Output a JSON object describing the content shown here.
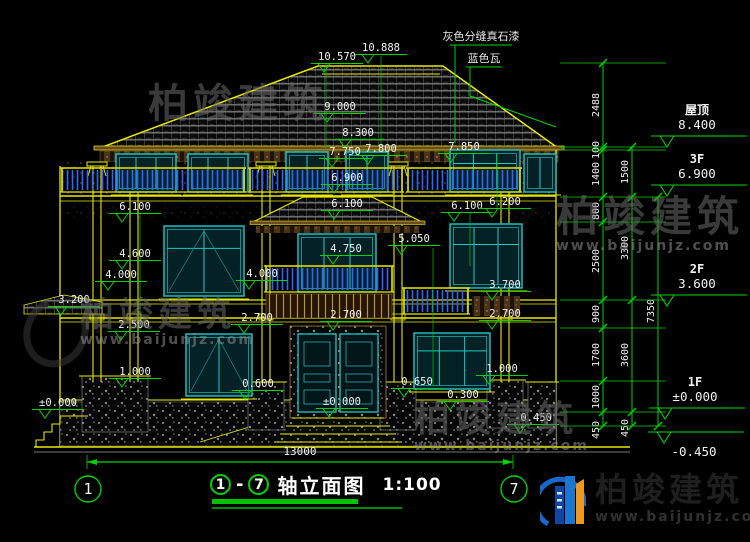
{
  "meta": {
    "bg": "#000000",
    "cad_yellow": "#e8e800",
    "dim_green": "#00d400",
    "window_cyan": "#20c8c8",
    "rail_blue": "#2e68ff",
    "text_white": "#f2f2f2"
  },
  "annotations": {
    "roof_notes": [
      {
        "text": "灰色分缝真石漆",
        "x": 481,
        "y": 40,
        "ul": [
          450,
          512,
          45
        ],
        "leader": [
          [
            455,
            45
          ],
          [
            455,
            143
          ]
        ]
      },
      {
        "text": "蓝色瓦",
        "x": 484,
        "y": 62,
        "ul": [
          466,
          502,
          67
        ],
        "leader": [
          [
            470,
            67
          ],
          [
            470,
            96
          ],
          [
            556,
            127
          ]
        ]
      }
    ],
    "levels": [
      {
        "v": "10.570",
        "x": 337,
        "y": 60
      },
      {
        "v": "10.888",
        "x": 381,
        "y": 51
      },
      {
        "v": "9.000",
        "x": 340,
        "y": 110
      },
      {
        "v": "8.300",
        "x": 358,
        "y": 136
      },
      {
        "v": "7.750",
        "x": 345,
        "y": 155
      },
      {
        "v": "7.800",
        "x": 381,
        "y": 152
      },
      {
        "v": "7.850",
        "x": 464,
        "y": 150
      },
      {
        "v": "6.900",
        "x": 347,
        "y": 181
      },
      {
        "v": "6.100",
        "x": 135,
        "y": 210
      },
      {
        "v": "6.100",
        "x": 347,
        "y": 207
      },
      {
        "v": "6.100",
        "x": 467,
        "y": 209
      },
      {
        "v": "6.200",
        "x": 505,
        "y": 205
      },
      {
        "v": "4.600",
        "x": 135,
        "y": 257
      },
      {
        "v": "4.750",
        "x": 346,
        "y": 252
      },
      {
        "v": "5.050",
        "x": 414,
        "y": 242
      },
      {
        "v": "4.000",
        "x": 121,
        "y": 278
      },
      {
        "v": "4.000",
        "x": 262,
        "y": 277
      },
      {
        "v": "3.700",
        "x": 505,
        "y": 288
      },
      {
        "v": "3.200",
        "x": 74,
        "y": 303
      },
      {
        "v": "2.500",
        "x": 134,
        "y": 328
      },
      {
        "v": "2.700",
        "x": 257,
        "y": 321
      },
      {
        "v": "2.700",
        "x": 346,
        "y": 318
      },
      {
        "v": "2.700",
        "x": 505,
        "y": 317
      },
      {
        "v": "1.000",
        "x": 135,
        "y": 375
      },
      {
        "v": "1.000",
        "x": 502,
        "y": 372
      },
      {
        "v": "0.600",
        "x": 258,
        "y": 387
      },
      {
        "v": "0.650",
        "x": 417,
        "y": 385
      },
      {
        "v": "0.300",
        "x": 463,
        "y": 398
      },
      {
        "v": "±0.000",
        "x": 58,
        "y": 406
      },
      {
        "v": "±0.000",
        "x": 342,
        "y": 405
      },
      {
        "v": "-0.450",
        "x": 533,
        "y": 421
      }
    ],
    "floor_marks": [
      {
        "label": "屋顶",
        "value": "8.400",
        "x": 697,
        "y": 114
      },
      {
        "label": "3F",
        "value": "6.900",
        "x": 697,
        "y": 163
      },
      {
        "label": "2F",
        "value": "3.600",
        "x": 697,
        "y": 273
      },
      {
        "label": "1F",
        "value": "±0.000",
        "x": 695,
        "y": 386
      },
      {
        "label": "",
        "value": "-0.450",
        "x": 694,
        "y": 456
      }
    ],
    "chains": [
      {
        "x": 603,
        "ticks": [
          63,
          147,
          150,
          197,
          222,
          300,
          328,
          381,
          412,
          426
        ],
        "labels": [
          {
            "t": "2488",
            "y": 105
          },
          {
            "t": "100",
            "y": 150
          },
          {
            "t": "1400",
            "y": 174
          },
          {
            "t": "800",
            "y": 211
          },
          {
            "t": "2500",
            "y": 261
          },
          {
            "t": "900",
            "y": 314
          },
          {
            "t": "1700",
            "y": 355
          },
          {
            "t": "1000",
            "y": 397
          },
          {
            "t": "450",
            "y": 430
          }
        ]
      },
      {
        "x": 632,
        "ticks": [
          147,
          197,
          300,
          412,
          426
        ],
        "labels": [
          {
            "t": "1500",
            "y": 172
          },
          {
            "t": "3300",
            "y": 248
          },
          {
            "t": "3600",
            "y": 355
          },
          {
            "t": "450",
            "y": 428
          }
        ]
      },
      {
        "x": 658,
        "ticks": [
          197,
          426
        ],
        "labels": [
          {
            "t": "7350",
            "y": 311
          }
        ]
      }
    ],
    "bottom_dim": {
      "value": "13000",
      "x1": 87,
      "x2": 513,
      "y": 462,
      "tx": 300,
      "ty": 455
    },
    "axis_bubbles": [
      {
        "n": "1",
        "x": 88,
        "y": 489
      },
      {
        "n": "7",
        "x": 514,
        "y": 489
      }
    ]
  },
  "title": {
    "axis_from": "1",
    "dash": "-",
    "axis_to": "7",
    "text": "轴立面图",
    "scale": "1:100"
  },
  "watermarks": [
    {
      "name": "柏竣建筑",
      "site": "",
      "x": 148,
      "y": 84,
      "size": 40
    },
    {
      "name": "柏竣建筑",
      "site": "www.baijunjz.com",
      "x": 556,
      "y": 196,
      "size": 42
    },
    {
      "name": "柏竣建筑",
      "site": "www.baijunjz.com",
      "x": 80,
      "y": 298,
      "size": 34
    },
    {
      "name": "柏竣建筑",
      "site": "www.baijunjz.com",
      "x": 414,
      "y": 402,
      "size": 36
    }
  ],
  "logo": {
    "name": "柏竣建筑",
    "site": "www.baijunjz.com"
  }
}
